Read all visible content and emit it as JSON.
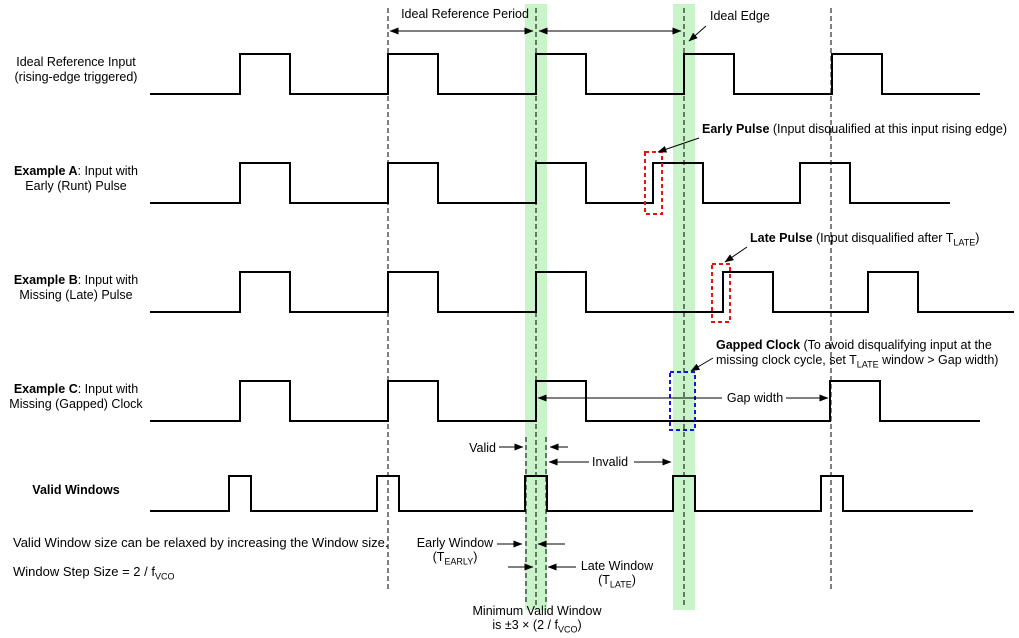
{
  "colors": {
    "band": "#c9f4c9",
    "line": "#000000",
    "red": "#ee1111",
    "blue": "#1414e0"
  },
  "top": {
    "period_label": "Ideal Reference Period",
    "ideal_edge_label": "Ideal Edge"
  },
  "rows": [
    {
      "l1": "Ideal Reference Input",
      "l2": "(rising-edge triggered)"
    },
    {
      "l1_bold": "Example A",
      "l1_rest": ": Input with",
      "l2": "Early (Runt) Pulse"
    },
    {
      "l1_bold": "Example B",
      "l1_rest": ": Input with",
      "l2": "Missing (Late) Pulse"
    },
    {
      "l1_bold": "Example C",
      "l1_rest": ": Input with",
      "l2": "Missing (Gapped) Clock"
    },
    {
      "l1_bold": "Valid Windows"
    }
  ],
  "callouts": {
    "early": {
      "title": "Early Pulse",
      "desc": " (Input disqualified at this input rising edge)"
    },
    "late": {
      "title": "Late Pulse",
      "desc_pre": " (Input disqualified after T",
      "desc_sub": "LATE",
      "desc_post": ")"
    },
    "gapped": {
      "title": "Gapped Clock",
      "line1_rest": " (To avoid disqualifying input at the",
      "line2_pre": "missing clock cycle, set T",
      "line2_sub": "LATE",
      "line2_post": " window > Gap width)"
    },
    "gap_width": "Gap width",
    "valid": "Valid",
    "invalid": "Invalid",
    "early_window": {
      "line1": "Early Window",
      "pre": "(T",
      "sub": "EARLY",
      "post": ")"
    },
    "late_window": {
      "line1": "Late Window",
      "pre": "(T",
      "sub": "LATE",
      "post": ")"
    },
    "min_window": {
      "line1": "Minimum Valid Window",
      "pre": "is ±3 × (2 / f",
      "sub": "VCO",
      "post": ")"
    }
  },
  "notes": {
    "note1": "Valid Window size can be relaxed by increasing the Window size.",
    "note2_pre": "Window Step Size = 2 / f",
    "note2_sub": "VCO"
  },
  "diagram": {
    "width": 1019,
    "height": 638,
    "band_y": 4,
    "band_h": 606,
    "bands": [
      {
        "x": 525,
        "w": 22
      },
      {
        "x": 673,
        "w": 22
      }
    ],
    "vlines": [
      {
        "x": 388,
        "y1": 8,
        "y2": 590
      },
      {
        "x": 536,
        "y1": 8,
        "y2": 606
      },
      {
        "x": 684,
        "y1": 8,
        "y2": 606
      },
      {
        "x": 831,
        "y1": 8,
        "y2": 590
      },
      {
        "x": 526,
        "y1": 437,
        "y2": 603
      },
      {
        "x": 546,
        "y1": 437,
        "y2": 603
      }
    ],
    "waves": [
      {
        "name": "ideal-reference-input",
        "x_start": 150,
        "x_end": 980,
        "base": 94,
        "top": 54,
        "pulse_width": 50,
        "pulses": [
          240,
          388,
          536,
          684,
          832
        ]
      },
      {
        "name": "example-a-early-runt",
        "x_start": 150,
        "x_end": 950,
        "base": 203,
        "top": 163,
        "pulse_width": 50,
        "pulses": [
          240,
          388,
          536,
          653,
          800
        ]
      },
      {
        "name": "example-b-late-pulse",
        "x_start": 150,
        "x_end": 1014,
        "base": 312,
        "top": 272,
        "pulse_width": 50,
        "pulses": [
          240,
          388,
          536,
          723,
          868
        ]
      },
      {
        "name": "example-c-gapped",
        "x_start": 150,
        "x_end": 980,
        "base": 421,
        "top": 381,
        "pulse_width": 50,
        "pulses": [
          240,
          388,
          536,
          830
        ]
      },
      {
        "name": "valid-windows",
        "x_start": 150,
        "x_end": 973,
        "base": 511,
        "top": 476,
        "pulse_width": 22,
        "pulses": [
          229,
          377,
          525,
          673,
          821
        ]
      }
    ],
    "boxes": [
      {
        "x": 645,
        "y": 152,
        "w": 17,
        "h": 62,
        "color": "red"
      },
      {
        "x": 712,
        "y": 264,
        "w": 18,
        "h": 58,
        "color": "red"
      },
      {
        "x": 670,
        "y": 372,
        "w": 25,
        "h": 58,
        "color": "blue"
      }
    ],
    "arrows": [
      {
        "x1": 390,
        "y1": 31,
        "x2": 533,
        "y2": 31,
        "heads": "both"
      },
      {
        "x1": 539,
        "y1": 31,
        "x2": 681,
        "y2": 31,
        "heads": "both"
      },
      {
        "x1": 706,
        "y1": 26,
        "x2": 689,
        "y2": 41,
        "heads": "end"
      },
      {
        "x1": 699,
        "y1": 138,
        "x2": 658,
        "y2": 152,
        "heads": "end"
      },
      {
        "x1": 747,
        "y1": 247,
        "x2": 725,
        "y2": 262,
        "heads": "end"
      },
      {
        "x1": 713,
        "y1": 358,
        "x2": 691,
        "y2": 371,
        "heads": "end"
      },
      {
        "x1": 722,
        "y1": 398,
        "x2": 538,
        "y2": 398,
        "heads": "end"
      },
      {
        "x1": 786,
        "y1": 398,
        "x2": 828,
        "y2": 398,
        "heads": "end"
      },
      {
        "x1": 499,
        "y1": 447,
        "x2": 523,
        "y2": 447,
        "heads": "end"
      },
      {
        "x1": 568,
        "y1": 447,
        "x2": 550,
        "y2": 447,
        "heads": "end"
      },
      {
        "x1": 589,
        "y1": 462,
        "x2": 549,
        "y2": 462,
        "heads": "end"
      },
      {
        "x1": 634,
        "y1": 462,
        "x2": 671,
        "y2": 462,
        "heads": "end"
      },
      {
        "x1": 497,
        "y1": 544,
        "x2": 522,
        "y2": 544,
        "heads": "end"
      },
      {
        "x1": 565,
        "y1": 544,
        "x2": 538,
        "y2": 544,
        "heads": "end"
      },
      {
        "x1": 508,
        "y1": 567,
        "x2": 533,
        "y2": 567,
        "heads": "end"
      },
      {
        "x1": 576,
        "y1": 567,
        "x2": 548,
        "y2": 567,
        "heads": "end"
      }
    ]
  }
}
